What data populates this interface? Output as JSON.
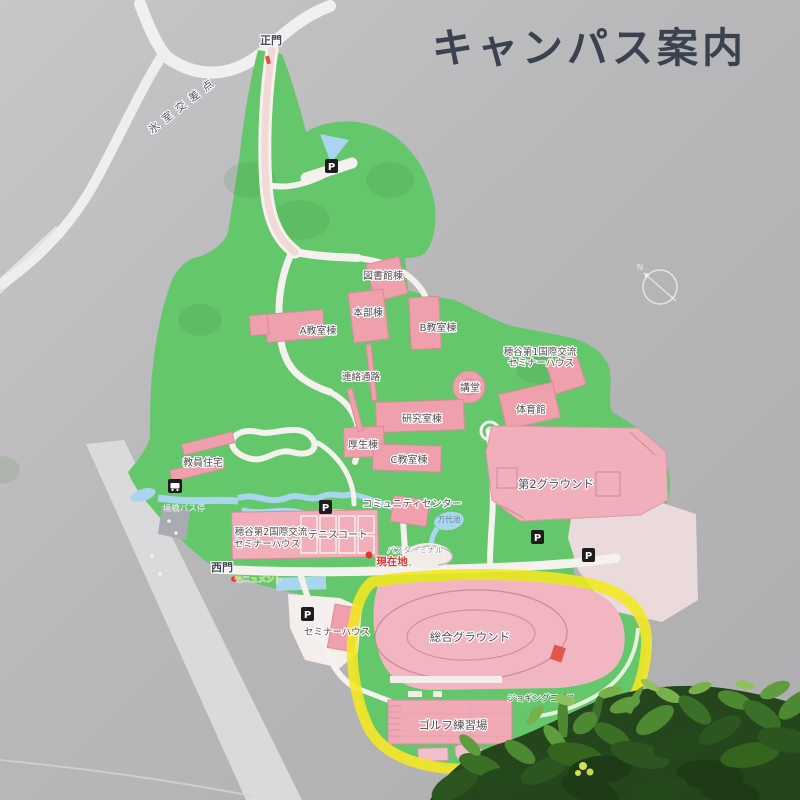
{
  "sign": {
    "title": "キャンパス案内"
  },
  "labels": [
    {
      "name": "main-gate",
      "text": "正門"
    },
    {
      "name": "intersection",
      "text": "氷室交差点"
    },
    {
      "name": "library",
      "text": "図書館棟"
    },
    {
      "name": "headquarters",
      "text": "本部棟"
    },
    {
      "name": "bldg-a",
      "text": "A教室棟"
    },
    {
      "name": "bldg-b",
      "text": "B教室棟"
    },
    {
      "name": "hotani1-line1",
      "text": "穂谷第1国際交流"
    },
    {
      "name": "hotani1-line2",
      "text": "セミナーハウス"
    },
    {
      "name": "corridor",
      "text": "連絡通路"
    },
    {
      "name": "auditorium",
      "text": "講堂"
    },
    {
      "name": "research-bldg",
      "text": "研究室棟"
    },
    {
      "name": "gymnasium",
      "text": "体育館"
    },
    {
      "name": "welfare-bldg",
      "text": "厚生棟"
    },
    {
      "name": "bldg-c",
      "text": "C教室棟"
    },
    {
      "name": "faculty-housing",
      "text": "教員住宅"
    },
    {
      "name": "ground-no2",
      "text": "第2グラウンド"
    },
    {
      "name": "community-center",
      "text": "コミュニティセンター"
    },
    {
      "name": "bus-stop",
      "text": "境橋バス停"
    },
    {
      "name": "hotani2-line1",
      "text": "穂谷第2国際交流"
    },
    {
      "name": "hotani2-line2",
      "text": "セミナーハウス"
    },
    {
      "name": "tennis-court",
      "text": "テニスコート"
    },
    {
      "name": "mandai-pond",
      "text": "万代池"
    },
    {
      "name": "bus-terminal",
      "text": "バスターミナル"
    },
    {
      "name": "current-location",
      "text": "現在地"
    },
    {
      "name": "west-gate",
      "text": "西門"
    },
    {
      "name": "monument",
      "text": "モニュメント"
    },
    {
      "name": "seminar-house",
      "text": "セミナーハウス"
    },
    {
      "name": "main-ground",
      "text": "総合グラウンド"
    },
    {
      "name": "jogging-course",
      "text": "ジョギングコース"
    },
    {
      "name": "golf-range",
      "text": "ゴルフ練習場"
    }
  ],
  "icons": {
    "parking_label": "P",
    "compass_north": "N"
  },
  "colors": {
    "background_gray": "#b6b5b7",
    "campus_green": "#65c76b",
    "building_pink": "#efa0ac",
    "ground_pink": "#f2b6c3",
    "water_blue": "#a9d6ee",
    "road_white": "#f5f1ee",
    "highlight_yellow": "#f2e81f",
    "title_color": "#39424e",
    "current_location_red": "#e0362e"
  }
}
